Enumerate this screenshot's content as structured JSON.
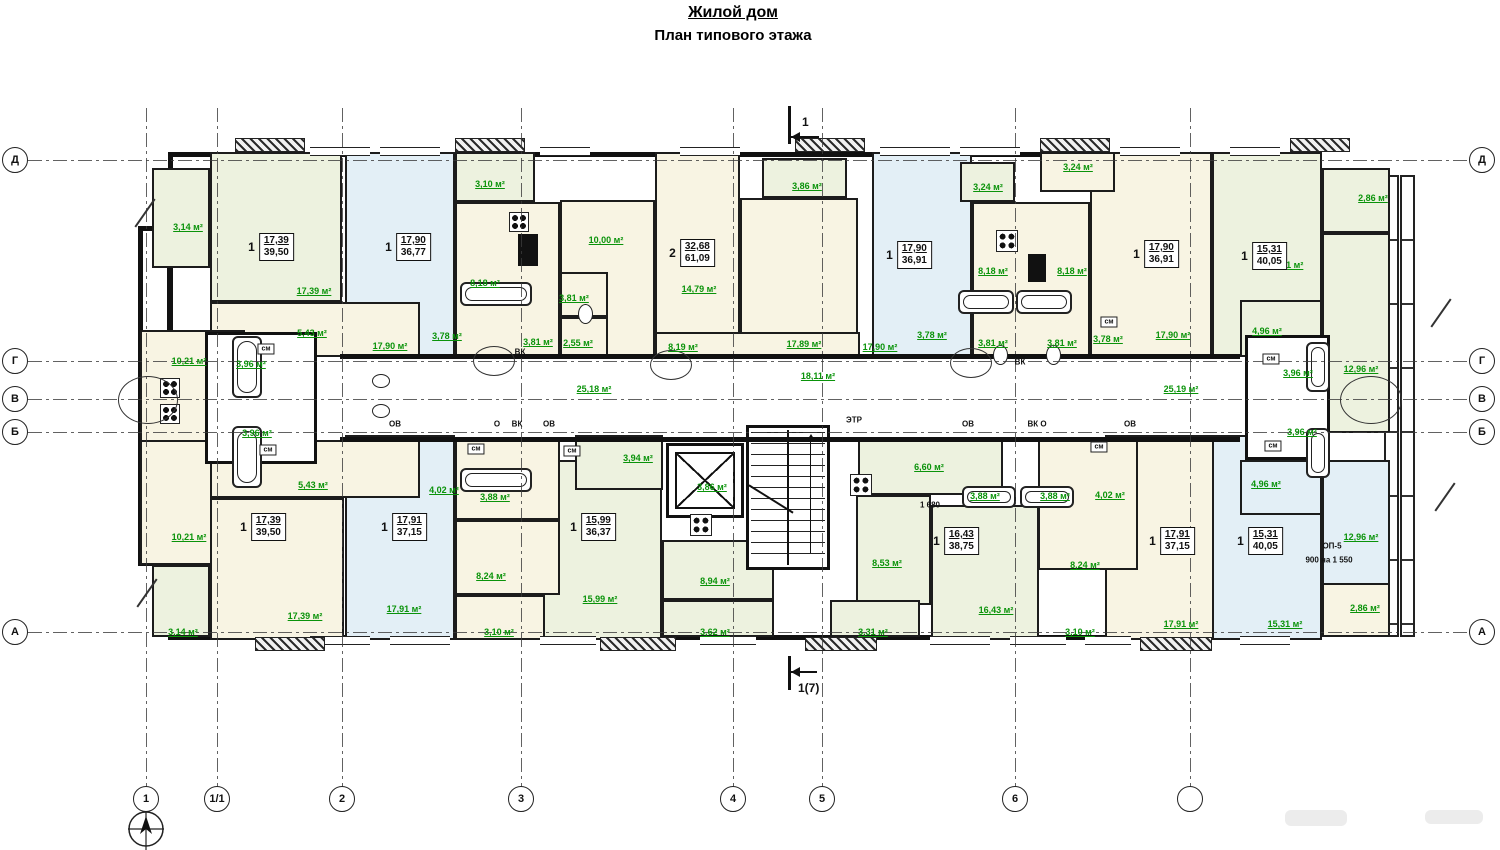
{
  "title": {
    "line1": "Жилой дом",
    "line2": "План типового  этажа"
  },
  "colors": {
    "green": "#edf2df",
    "blue": "#e3eff6",
    "cream": "#f8f4e3",
    "white": "#ffffff",
    "label_green": "#0a930a",
    "wall": "#1c1c1c"
  },
  "axes": {
    "horizontal": [
      [
        160,
        "Д"
      ],
      [
        361,
        "Г"
      ],
      [
        399,
        "В"
      ],
      [
        432,
        "Б"
      ],
      [
        632,
        "А"
      ]
    ],
    "vertical": [
      [
        146,
        "1"
      ],
      [
        217,
        "1/1"
      ],
      [
        342,
        "2"
      ],
      [
        521,
        "3"
      ],
      [
        733,
        "4"
      ],
      [
        822,
        "5"
      ],
      [
        1015,
        "6"
      ],
      [
        1190,
        ""
      ]
    ]
  },
  "section_markers": {
    "top": "1",
    "bottom": "1(7)"
  },
  "rooms": [
    [
      210,
      152,
      132,
      150,
      "g"
    ],
    [
      345,
      152,
      110,
      205,
      "b"
    ],
    [
      455,
      202,
      105,
      155,
      "cr"
    ],
    [
      560,
      200,
      95,
      157,
      "cr"
    ],
    [
      655,
      152,
      85,
      205,
      "cr"
    ],
    [
      740,
      198,
      118,
      159,
      "cr"
    ],
    [
      872,
      152,
      100,
      205,
      "b"
    ],
    [
      972,
      202,
      118,
      155,
      "cr"
    ],
    [
      1090,
      152,
      122,
      205,
      "cr"
    ],
    [
      1212,
      152,
      110,
      205,
      "g"
    ],
    [
      1322,
      233,
      68,
      200,
      "g"
    ],
    [
      210,
      302,
      210,
      55,
      "cr"
    ],
    [
      152,
      168,
      58,
      100,
      "g"
    ],
    [
      455,
      152,
      80,
      50,
      "g"
    ],
    [
      560,
      272,
      48,
      45,
      "cr"
    ],
    [
      560,
      317,
      48,
      40,
      "cr"
    ],
    [
      762,
      158,
      85,
      40,
      "g"
    ],
    [
      655,
      332,
      205,
      25,
      "cr"
    ],
    [
      960,
      162,
      55,
      40,
      "g"
    ],
    [
      1040,
      152,
      75,
      40,
      "cr"
    ],
    [
      1322,
      168,
      68,
      65,
      "g"
    ],
    [
      1240,
      300,
      82,
      57,
      "g"
    ],
    [
      140,
      330,
      105,
      112,
      "cr"
    ],
    [
      140,
      440,
      105,
      125,
      "cr"
    ],
    [
      210,
      498,
      134,
      142,
      "cr"
    ],
    [
      345,
      435,
      110,
      205,
      "b"
    ],
    [
      530,
      460,
      132,
      180,
      "g"
    ],
    [
      1105,
      435,
      125,
      205,
      "cr"
    ],
    [
      1212,
      435,
      110,
      205,
      "b"
    ],
    [
      1322,
      460,
      68,
      177,
      "b"
    ],
    [
      210,
      440,
      210,
      58,
      "cr"
    ],
    [
      152,
      565,
      58,
      72,
      "g"
    ],
    [
      455,
      440,
      105,
      80,
      "cr"
    ],
    [
      455,
      520,
      105,
      75,
      "cr"
    ],
    [
      455,
      595,
      90,
      45,
      "cr"
    ],
    [
      575,
      435,
      88,
      55,
      "g"
    ],
    [
      662,
      540,
      112,
      60,
      "g"
    ],
    [
      662,
      600,
      112,
      37,
      "g"
    ],
    [
      858,
      440,
      145,
      55,
      "g"
    ],
    [
      856,
      495,
      75,
      110,
      "g"
    ],
    [
      931,
      505,
      108,
      135,
      "g"
    ],
    [
      830,
      600,
      90,
      37,
      "g"
    ],
    [
      1038,
      440,
      100,
      130,
      "cr"
    ],
    [
      1240,
      460,
      82,
      55,
      "b"
    ],
    [
      1322,
      583,
      68,
      54,
      "cr"
    ]
  ],
  "cores": [
    [
      205,
      332,
      112,
      132
    ],
    [
      1245,
      335,
      85,
      125
    ]
  ],
  "area_labels": [
    [
      188,
      227,
      "3,14 м²"
    ],
    [
      314,
      291,
      "17,39 м²"
    ],
    [
      312,
      333,
      "5,43 м²"
    ],
    [
      390,
      346,
      "17,90 м²"
    ],
    [
      490,
      184,
      "3,10 м²"
    ],
    [
      485,
      283,
      "8,18 м²"
    ],
    [
      447,
      336,
      "3,78 м²"
    ],
    [
      538,
      342,
      "3,81 м²"
    ],
    [
      606,
      240,
      "10,00 м²"
    ],
    [
      574,
      298,
      "3,81 м²"
    ],
    [
      578,
      343,
      "2,55 м²"
    ],
    [
      699,
      289,
      "14,79 м²"
    ],
    [
      807,
      186,
      "3,86 м²"
    ],
    [
      683,
      347,
      "8,19 м²"
    ],
    [
      804,
      344,
      "17,89 м²"
    ],
    [
      880,
      347,
      "17,90 м²"
    ],
    [
      988,
      187,
      "3,24 м²"
    ],
    [
      1078,
      167,
      "3,24 м²"
    ],
    [
      993,
      271,
      "8,18 м²"
    ],
    [
      1072,
      271,
      "8,18 м²"
    ],
    [
      932,
      335,
      "3,78 м²"
    ],
    [
      1108,
      339,
      "3,78 м²"
    ],
    [
      993,
      343,
      "3,81 м²"
    ],
    [
      1062,
      343,
      "3,81 м²"
    ],
    [
      1173,
      335,
      "17,90 м²"
    ],
    [
      1286,
      265,
      "15,31 м²"
    ],
    [
      1267,
      331,
      "4,96 м²"
    ],
    [
      1298,
      373,
      "3,96 м²"
    ],
    [
      1361,
      369,
      "12,96 м²"
    ],
    [
      1373,
      198,
      "2,86 м²"
    ],
    [
      594,
      389,
      "25,18 м²"
    ],
    [
      818,
      376,
      "18,11 м²"
    ],
    [
      1181,
      389,
      "25,19 м²"
    ],
    [
      189,
      361,
      "10,21 м²"
    ],
    [
      251,
      364,
      "3,96 м²"
    ],
    [
      189,
      537,
      "10,21 м²"
    ],
    [
      257,
      433,
      "3,96 м²"
    ],
    [
      313,
      485,
      "5,43 м²"
    ],
    [
      305,
      616,
      "17,39 м²"
    ],
    [
      183,
      632,
      "3,14 м²"
    ],
    [
      404,
      609,
      "17,91 м²"
    ],
    [
      444,
      490,
      "4,02 м²"
    ],
    [
      495,
      497,
      "3,88 м²"
    ],
    [
      491,
      576,
      "8,24 м²"
    ],
    [
      499,
      632,
      "3,10 м²"
    ],
    [
      638,
      458,
      "3,94 м²"
    ],
    [
      600,
      599,
      "15,99 м²"
    ],
    [
      712,
      487,
      "3,86 м²"
    ],
    [
      715,
      581,
      "8,94 м²"
    ],
    [
      715,
      632,
      "3,62 м²"
    ],
    [
      929,
      467,
      "6,60 м²"
    ],
    [
      887,
      563,
      "8,53 м²"
    ],
    [
      996,
      610,
      "16,43 м²"
    ],
    [
      873,
      632,
      "3,31 м²"
    ],
    [
      985,
      496,
      "3,88 м²"
    ],
    [
      1055,
      496,
      "3,88 м²"
    ],
    [
      1110,
      495,
      "4,02 м²"
    ],
    [
      1085,
      565,
      "8,24 м²"
    ],
    [
      1080,
      632,
      "3,10 м²"
    ],
    [
      1181,
      624,
      "17,91 м²"
    ],
    [
      1266,
      484,
      "4,96 м²"
    ],
    [
      1302,
      432,
      "3,96 м²"
    ],
    [
      1361,
      537,
      "12,96 м²"
    ],
    [
      1285,
      624,
      "15,31 м²"
    ],
    [
      1365,
      608,
      "2,86 м²"
    ]
  ],
  "apartments": [
    [
      271,
      247,
      "1",
      "17,39",
      "39,50"
    ],
    [
      408,
      247,
      "1",
      "17,90",
      "36,77"
    ],
    [
      692,
      253,
      "2",
      "32,68",
      "61,09"
    ],
    [
      909,
      255,
      "1",
      "17,90",
      "36,91"
    ],
    [
      1156,
      254,
      "1",
      "17,90",
      "36,91"
    ],
    [
      1264,
      256,
      "1",
      "15,31",
      "40,05"
    ],
    [
      263,
      527,
      "1",
      "17,39",
      "39,50"
    ],
    [
      404,
      527,
      "1",
      "17,91",
      "37,15"
    ],
    [
      593,
      527,
      "1",
      "15,99",
      "36,37"
    ],
    [
      956,
      541,
      "1",
      "16,43",
      "38,75"
    ],
    [
      1172,
      541,
      "1",
      "17,91",
      "37,15"
    ],
    [
      1260,
      541,
      "1",
      "15,31",
      "40,05"
    ]
  ],
  "text_labels": [
    [
      395,
      424,
      "ОВ",
      0
    ],
    [
      497,
      424,
      "О",
      0
    ],
    [
      517,
      424,
      "ВК",
      0
    ],
    [
      549,
      424,
      "ОВ",
      0
    ],
    [
      968,
      424,
      "ОВ",
      0
    ],
    [
      1037,
      424,
      "ВК О",
      0
    ],
    [
      1130,
      424,
      "ОВ",
      0
    ],
    [
      520,
      352,
      "ВК",
      0
    ],
    [
      1020,
      362,
      "ВК",
      0
    ],
    [
      854,
      420,
      "ЭТР",
      0
    ],
    [
      266,
      349,
      "см",
      1
    ],
    [
      268,
      450,
      "см",
      1
    ],
    [
      476,
      449,
      "см",
      1
    ],
    [
      572,
      451,
      "см",
      1
    ],
    [
      1271,
      359,
      "см",
      1
    ],
    [
      1273,
      446,
      "см",
      1
    ],
    [
      1099,
      447,
      "см",
      1
    ],
    [
      1109,
      322,
      "см",
      1
    ],
    [
      930,
      505,
      "1 680",
      0
    ],
    [
      1332,
      546,
      "ОП-5",
      0
    ],
    [
      1329,
      560,
      "900 на 1 550",
      0
    ]
  ],
  "windows": {
    "top": [
      [
        310,
        60
      ],
      [
        380,
        60
      ],
      [
        540,
        50
      ],
      [
        680,
        60
      ],
      [
        880,
        70
      ],
      [
        960,
        60
      ],
      [
        1120,
        60
      ],
      [
        1230,
        50
      ]
    ],
    "bottom": [
      [
        310,
        60
      ],
      [
        390,
        60
      ],
      [
        540,
        56
      ],
      [
        700,
        56
      ],
      [
        930,
        60
      ],
      [
        1010,
        56
      ],
      [
        1085,
        46
      ],
      [
        1240,
        50
      ]
    ]
  },
  "hatches": {
    "top": [
      [
        235,
        70
      ],
      [
        455,
        70
      ],
      [
        795,
        70
      ],
      [
        1040,
        70
      ],
      [
        1290,
        60
      ]
    ],
    "bottom": [
      [
        255,
        70
      ],
      [
        600,
        76
      ],
      [
        805,
        72
      ],
      [
        1140,
        72
      ]
    ]
  },
  "fixtures": [
    [
      "tub",
      232,
      336,
      30,
      62
    ],
    [
      "tub",
      232,
      426,
      30,
      62
    ],
    [
      "tub",
      460,
      282,
      72,
      24
    ],
    [
      "tub",
      460,
      468,
      72,
      24
    ],
    [
      "tub",
      958,
      290,
      56,
      24
    ],
    [
      "tub",
      1016,
      290,
      56,
      24
    ],
    [
      "tub",
      962,
      486,
      54,
      22
    ],
    [
      "tub",
      1020,
      486,
      54,
      22
    ],
    [
      "tub",
      1306,
      342,
      24,
      50
    ],
    [
      "tub",
      1306,
      428,
      24,
      50
    ],
    [
      "stove",
      160,
      378,
      20,
      20
    ],
    [
      "stove",
      160,
      404,
      20,
      20
    ],
    [
      "stove",
      509,
      212,
      20,
      20
    ],
    [
      "stove",
      996,
      230,
      22,
      22
    ],
    [
      "stove",
      690,
      514,
      22,
      22
    ],
    [
      "stove",
      850,
      474,
      22,
      22
    ],
    [
      "sq",
      518,
      234,
      20,
      32
    ],
    [
      "sq",
      1028,
      254,
      18,
      28
    ],
    [
      "wc",
      578,
      304,
      15,
      20
    ],
    [
      "wc",
      993,
      345,
      15,
      20
    ],
    [
      "wc",
      1046,
      345,
      15,
      20
    ],
    [
      "wc",
      372,
      374,
      18,
      14
    ],
    [
      "wc",
      372,
      404,
      18,
      14
    ],
    [
      "oval",
      473,
      346,
      40,
      28
    ],
    [
      "oval",
      650,
      350,
      40,
      28
    ],
    [
      "oval",
      950,
      348,
      40,
      28
    ],
    [
      "oval",
      118,
      376,
      58,
      46
    ],
    [
      "oval",
      1340,
      376,
      60,
      46
    ]
  ],
  "breaks": [
    [
      128,
      212
    ],
    [
      130,
      592
    ],
    [
      1424,
      312
    ],
    [
      1428,
      496
    ]
  ],
  "artifacts": [
    [
      1285,
      810,
      62,
      16
    ],
    [
      1425,
      810,
      58,
      14
    ]
  ]
}
